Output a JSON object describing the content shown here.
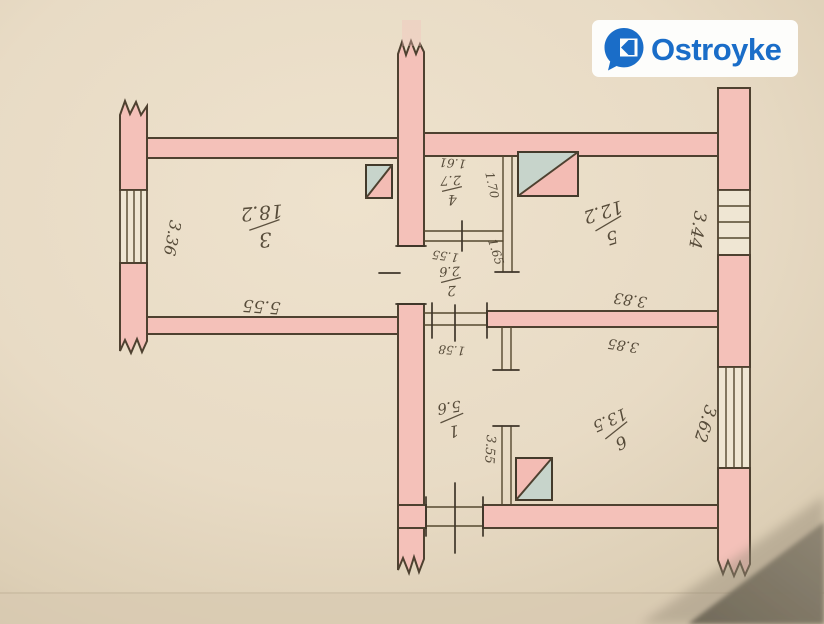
{
  "brand": {
    "name": "Ostroyke",
    "color": "#1a6dc8",
    "icon": "house-chat-bubble-icon"
  },
  "floor_plan": {
    "rooms": [
      {
        "number": "3",
        "area": "18.2",
        "width": "5.55",
        "depth": "3.36"
      },
      {
        "number": "4",
        "area": "2.7",
        "width": "1.61",
        "depth": "1.70"
      },
      {
        "number": "2",
        "area": "2.6",
        "width": "1.55",
        "depth": "1.65"
      },
      {
        "number": "5",
        "area": "12.2",
        "width": "3.83",
        "depth": "3.44"
      },
      {
        "number": "1",
        "area": "5.6",
        "width": "1.58",
        "depth": "3.55"
      },
      {
        "number": "6",
        "area": "13.5",
        "width": "3.85",
        "depth": "3.62"
      }
    ],
    "colors": {
      "wall": "#f4c1b9",
      "outline": "#4e4130",
      "vent_shaft": "#c7d4cb",
      "paper": "#e9dcc7",
      "pencil": "#433827"
    }
  }
}
